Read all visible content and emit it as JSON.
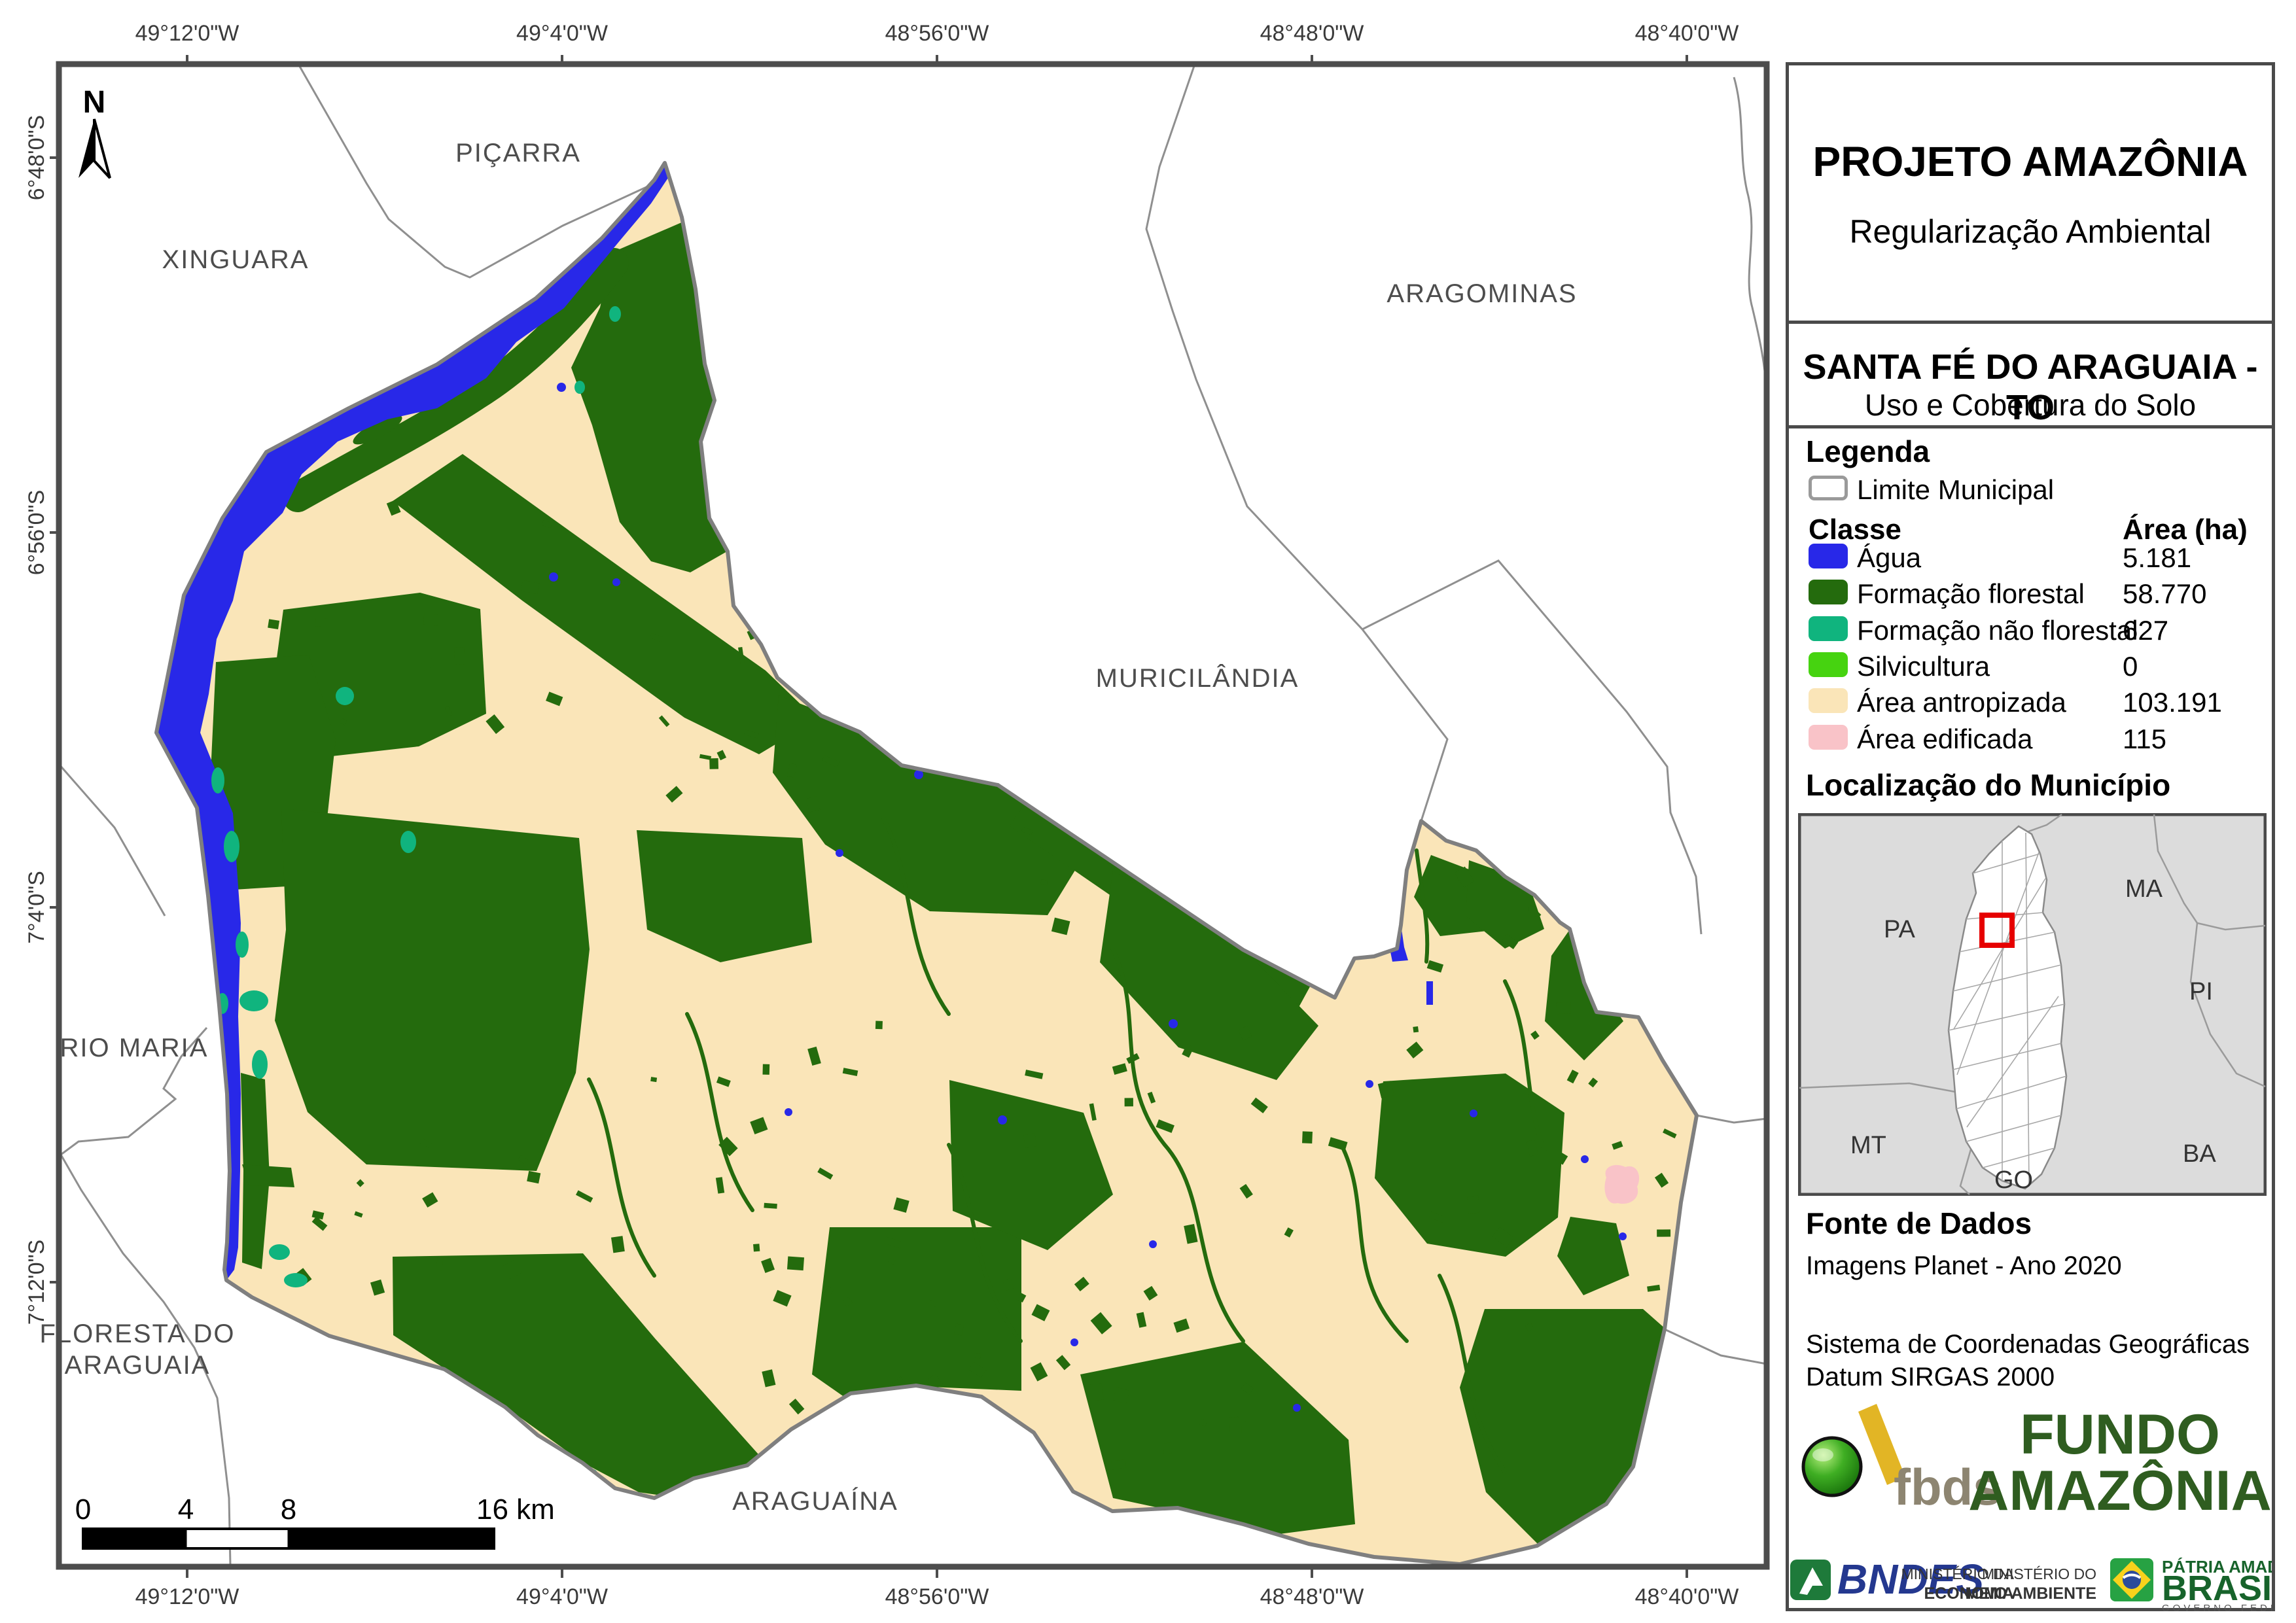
{
  "header": {
    "title": "PROJETO AMAZÔNIA",
    "subtitle": "Regularização Ambiental",
    "municipality": "SANTA FÉ DO ARAGUAIA - TO",
    "map_type": "Uso e Cobertura do Solo"
  },
  "legend": {
    "heading": "Legenda",
    "limite_label": "Limite Municipal",
    "col_class": "Classe",
    "col_area": "Área (ha)",
    "classes": [
      {
        "label": "Água",
        "area": "5.181",
        "color": "#2828E8"
      },
      {
        "label": "Formação florestal",
        "area": "58.770",
        "color": "#246B0D"
      },
      {
        "label": "Formação não florestal",
        "area": "627",
        "color": "#10B47E"
      },
      {
        "label": "Silvicultura",
        "area": "0",
        "color": "#46D310"
      },
      {
        "label": "Área antropizada",
        "area": "103.191",
        "color": "#FAE5B8"
      },
      {
        "label": "Área edificada",
        "area": "115",
        "color": "#F9C3C8"
      }
    ]
  },
  "inset": {
    "heading": "Localização do Município",
    "states": [
      "PA",
      "MA",
      "PI",
      "MT",
      "BA",
      "GO"
    ]
  },
  "source": {
    "heading": "Fonte de Dados",
    "line1": "Imagens Planet - Ano 2020",
    "line2": "Sistema de Coordenadas Geográficas",
    "line3": "Datum SIRGAS 2000"
  },
  "logos": {
    "fbds": "fbds",
    "fundo_line1": "FUNDO",
    "fundo_line2": "AMAZÔNIA",
    "bndes": "BNDES",
    "min_econ_1": "MINISTÉRIO DA",
    "min_econ_2": "ECONOMIA",
    "min_env_1": "MINISTÉRIO DO",
    "min_env_2": "MEIO AMBIENTE",
    "patria_1": "PÁTRIA AMADA",
    "patria_2": "BRASIL",
    "patria_3": "GOVERNO FEDERAL"
  },
  "map": {
    "north_label": "N",
    "top_coords": [
      "49°12'0\"W",
      "49°4'0\"W",
      "48°56'0\"W",
      "48°48'0\"W",
      "48°40'0\"W"
    ],
    "bottom_coords": [
      "49°12'0\"W",
      "49°4'0\"W",
      "48°56'0\"W",
      "48°48'0\"W",
      "48°40'0\"W"
    ],
    "left_coords": [
      "6°48'0\"S",
      "6°56'0\"S",
      "7°4'0\"S",
      "7°12'0\"S"
    ],
    "places": [
      "XINGUARA",
      "PIÇARRA",
      "ARAGOMINAS",
      "MURICILÂNDIA",
      "RIO MARIA",
      "FLORESTA DO",
      "ARAGUAIA",
      "ARAGUAÍNA"
    ],
    "scale": {
      "t0": "0",
      "t4": "4",
      "t8": "8",
      "t16": "16 km"
    }
  },
  "colors": {
    "agua": "#2828E8",
    "florestal": "#246B0D",
    "nao_florestal": "#10B47E",
    "silvicultura": "#46D310",
    "antropizada": "#FAE5B8",
    "edificada": "#F9C3C8",
    "frame": "#4D4D4D",
    "boundary": "#7F7F7F",
    "neighbor": "#8F8F8F",
    "map_label": "#4D4D4D",
    "inset_bg": "#DCDCDC",
    "highlight_red": "#E60000",
    "bndes_blue": "#24388F",
    "brand_green": "#17632B",
    "fundo_green": "#2F5D20",
    "gold": "#E2B525",
    "fbds_text": "#8D8571"
  }
}
